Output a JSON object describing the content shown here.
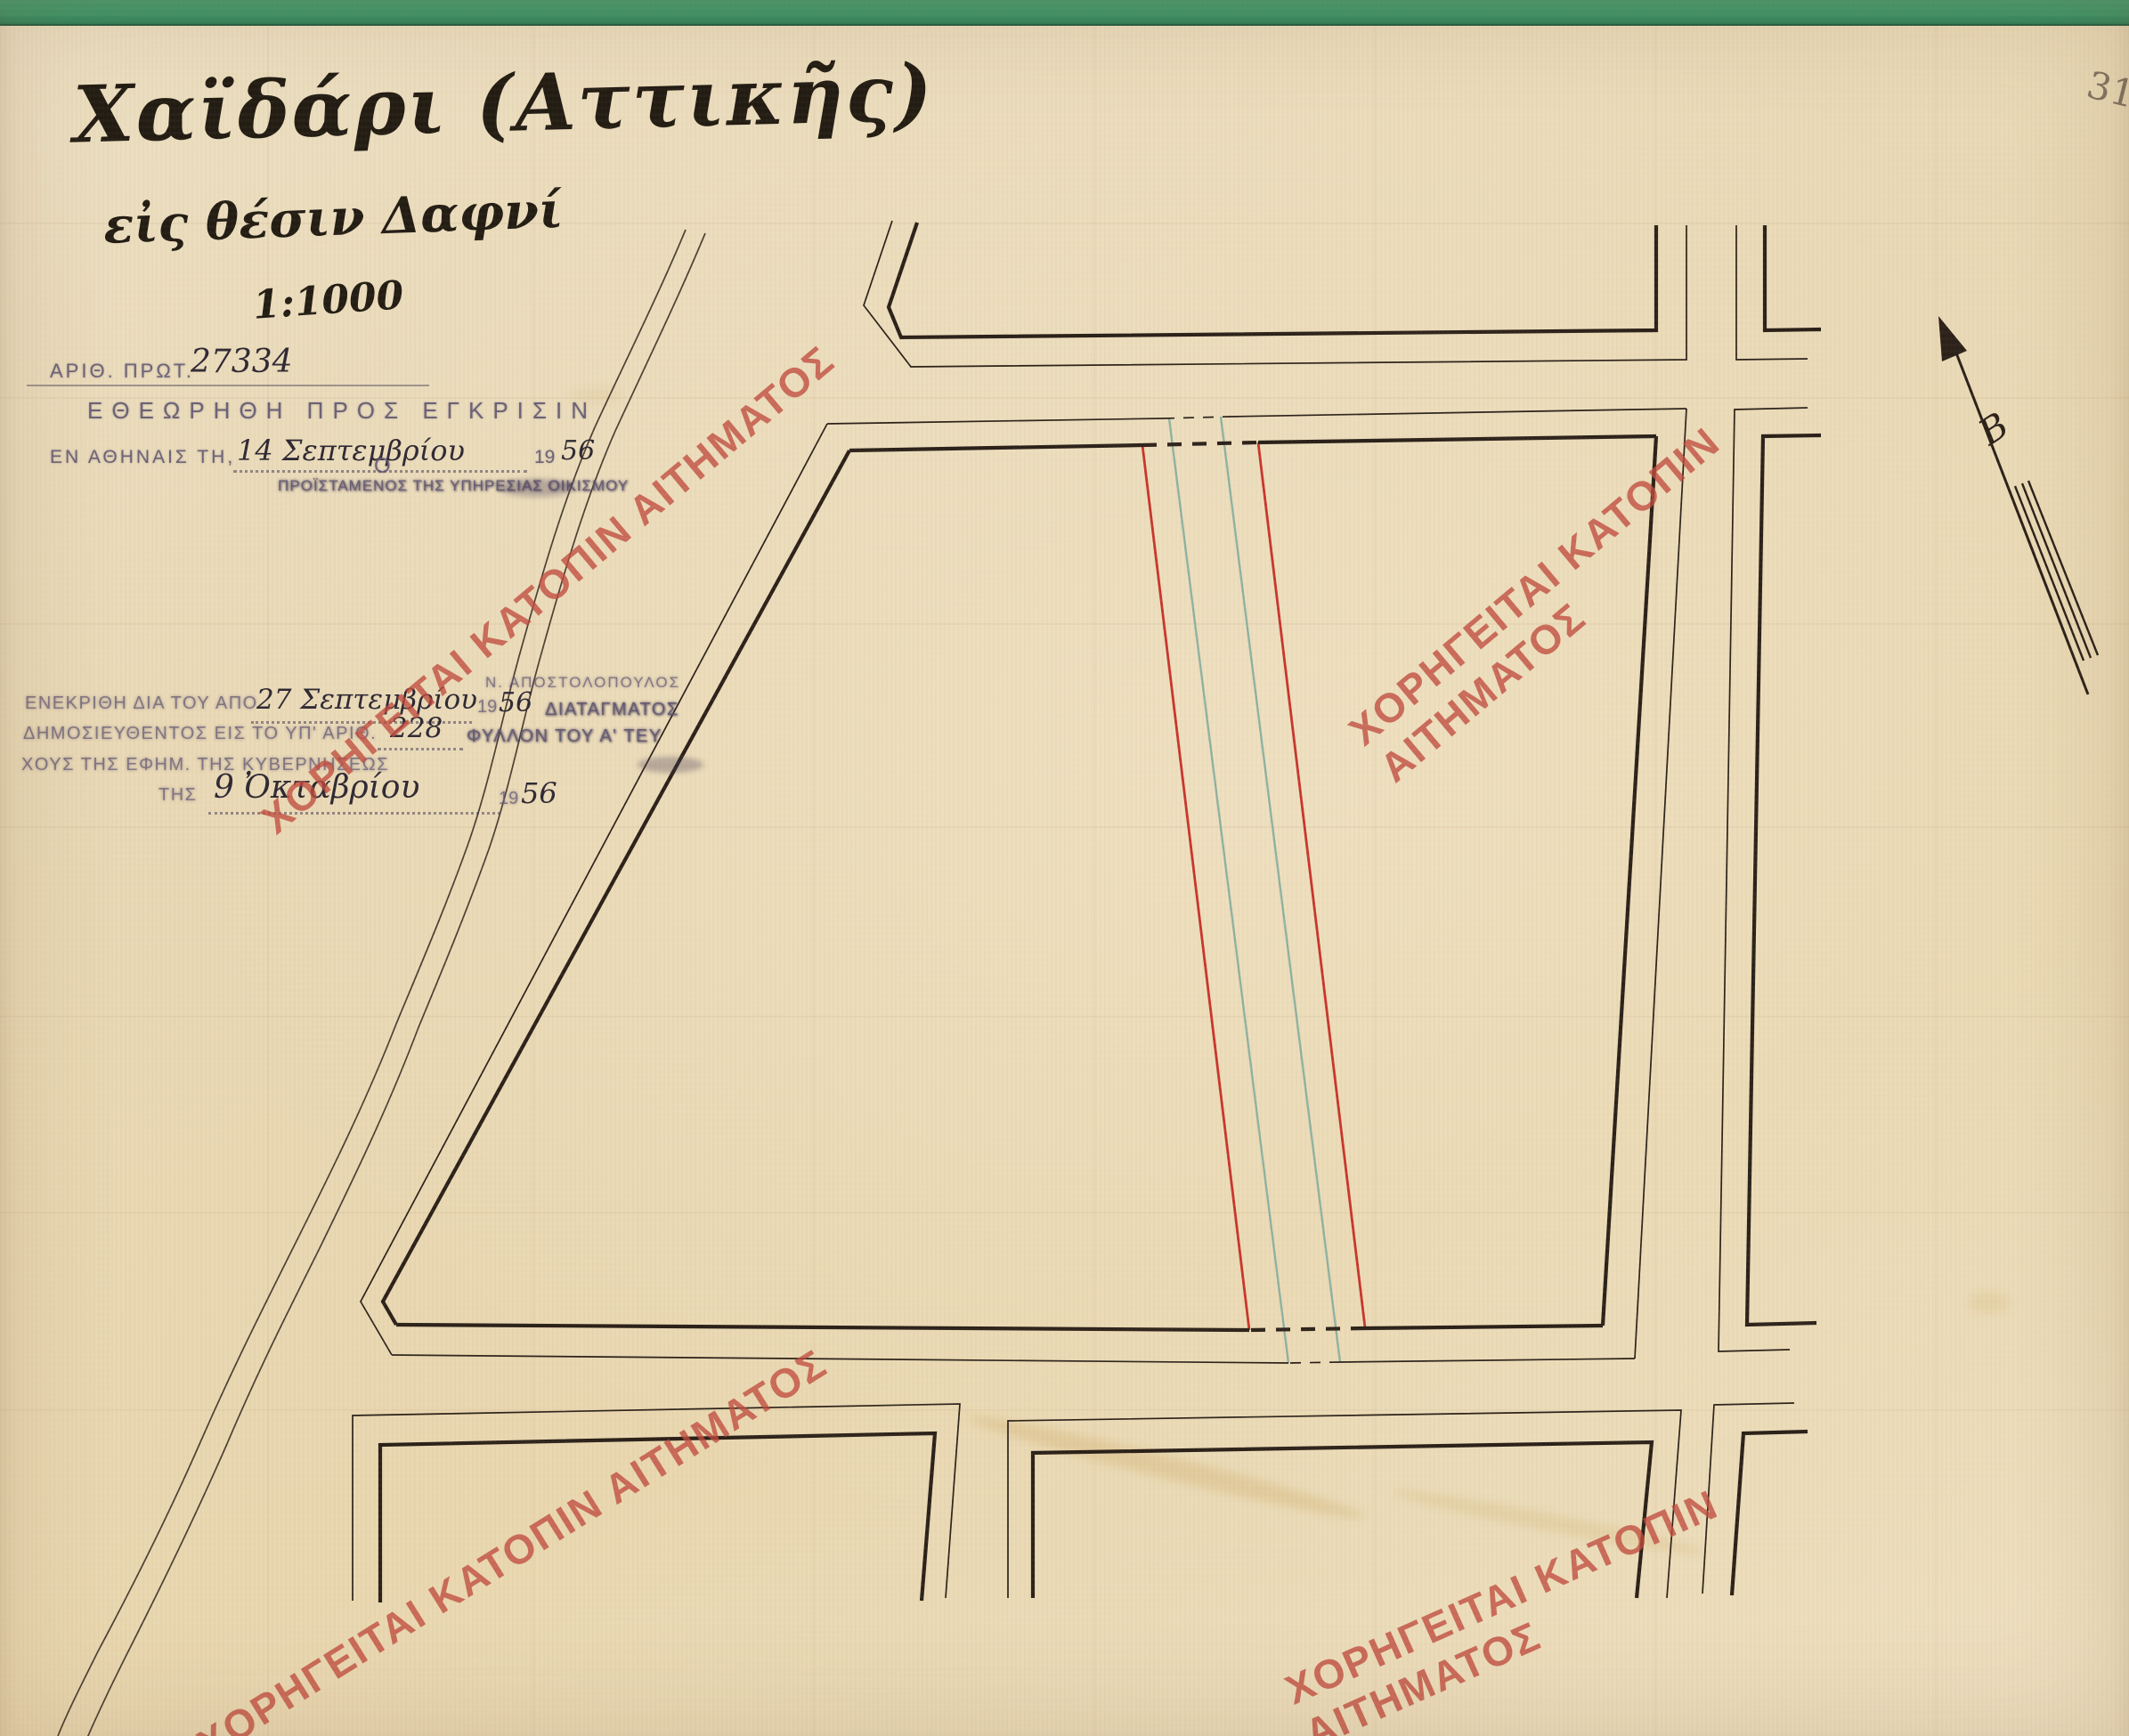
{
  "document": {
    "page_number": "31",
    "title": "Χαϊδάρι (Αττικῆς)",
    "subtitle": "εἰς θέσιν Δαφνί",
    "scale": "1:1000",
    "north_label": "Β"
  },
  "protocol": {
    "label": "ΑΡΙΘ. ΠΡΩΤ.",
    "number": "27334"
  },
  "approval": {
    "line1": "ΕΘΕΩΡΗΘΗ ΠΡΟΣ ΕΓΚΡΙΣΙΝ",
    "place_prefix": "ΕΝ ΑΘΗΝΑΙΣ ΤΗ,",
    "date_hand": "14 Σεπτεμβρίου",
    "year_printed": "19",
    "year_hand": "56",
    "o_label": "Ο",
    "official_title": "ΠΡΟΪΣΤΑΜΕΝΟΣ ΤΗΣ ΥΠΗΡΕΣΙΑΣ ΟΙΚΙΣΜΟΥ"
  },
  "decree": {
    "approved_prefix": "ΕΝΕΚΡΙΘΗ ΔΙΑ ΤΟΥ ΑΠΟ",
    "approved_date_hand": "27 Σεπτεμβρίου",
    "approved_year_printed": "19",
    "approved_year_hand": "56",
    "approved_suffix": "ΔΙΑΤΑΓΜΑΤΟΣ",
    "published_prefix": "ΔΗΜΟΣΙΕΥΘΕΝΤΟΣ ΕΙΣ ΤΟ ΥΠ' ΑΡΙΘ.",
    "gazette_number_hand": "228",
    "published_suffix": "ΦΥΛΛΟΝ ΤΟΥ Α' ΤΕΥ",
    "line3": "ΧΟΥΣ ΤΗΣ ΕΦΗΜ. ΤΗΣ ΚΥΒΕΡΝΗΣΕΩΣ",
    "line4_prefix": "ΤΗΣ",
    "pub_date_hand": "9 Ὀκταβρίου",
    "pub_year_printed": "19",
    "pub_year_hand": "56",
    "signature": "Ν. ΑΠΟΣΤΟΛΟΠΟΥΛΟΣ"
  },
  "watermark": {
    "text": "ΧΟΡΗΓΕΙΤΑΙ ΚΑΤΟΠΙΝ ΑΙΤΗΜΑΤΟΣ",
    "color": "#c04a3e"
  },
  "map": {
    "ink_color": "#2b2119",
    "revision_line_color": "#c8352b",
    "secondary_line_color": "#8fb2a2",
    "paper_color": "#e9d8b4",
    "backing_strip_color": "#3c9a6e",
    "features": [
      "city-block-outlines",
      "street-grid",
      "red-revision-lines",
      "teal-prior-alignment-lines",
      "stream-course",
      "north-arrow"
    ]
  }
}
